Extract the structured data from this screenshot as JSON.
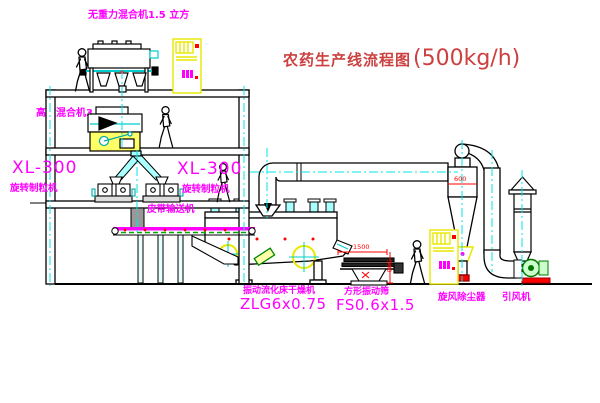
{
  "title": {
    "prefix": "农药生产线流程图",
    "capacity": "(500kg/h)"
  },
  "labels": {
    "gravity_mixer": "无重力混合机1.5 立方",
    "high_eff_mixer": "高效混合机3.5立方",
    "xl300_left": "XL-300",
    "granulator_left": "旋转制粒机",
    "xl300_right": "XL-300",
    "granulator_right": "旋转制粒机",
    "belt_conveyor": "皮带输送机",
    "dryer_name": "振动流化床干燥机",
    "dryer_model": "ZLG6x0.75",
    "sieve_name": "方形振动筛",
    "sieve_model": "FS0.6x1.5",
    "cyclone": "旋风除尘器",
    "fan": "引风机"
  },
  "dims": {
    "cyclone_dia": "600",
    "sieve_len": "1500",
    "sieve_h": "540"
  },
  "colors": {
    "label_magenta": "#ff00ff",
    "title_red": "#cc4040",
    "dimension_red": "#ff0000",
    "equipment_yellow": "#e8e800",
    "centerline_cyan": "#00e5e5",
    "belt_green": "#00aa00",
    "line_black": "#000000"
  }
}
